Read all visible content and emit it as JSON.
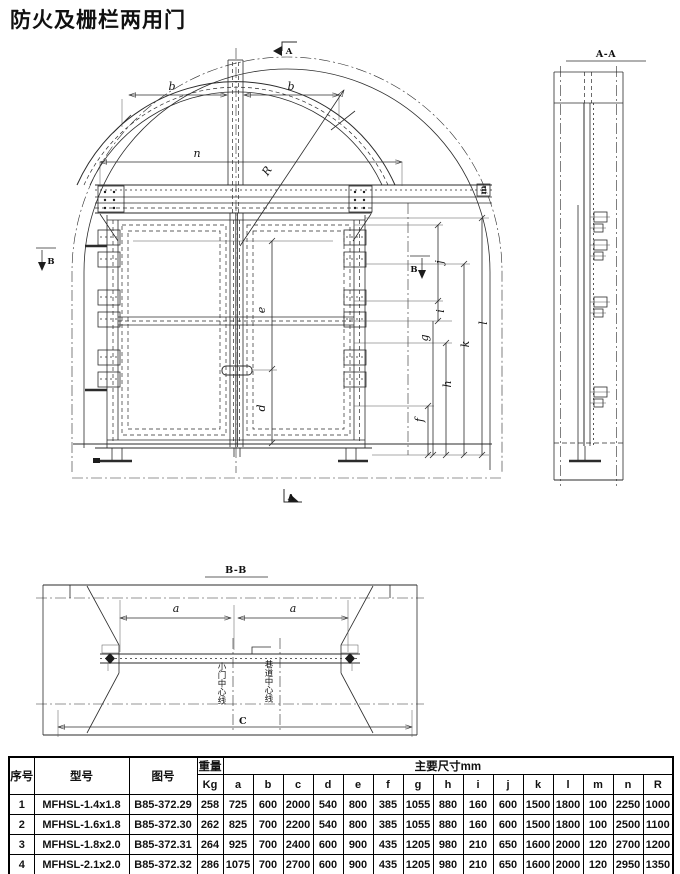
{
  "page": {
    "title": "防火及栅栏两用门"
  },
  "drawing": {
    "front_view": {
      "labels": {
        "b_left": "b",
        "b_right": "b",
        "n": "n",
        "R": "R",
        "e": "e",
        "d": "d",
        "f": "f",
        "g": "g",
        "h": "h",
        "i": "i",
        "j": "j",
        "k": "k",
        "l": "l",
        "m": "m"
      },
      "section_marks": {
        "a_top": "A",
        "a_bottom": "A",
        "b_left": "B",
        "b_right": "B"
      }
    },
    "section_aa": {
      "title": "A-A"
    },
    "section_bb": {
      "title": "B-B",
      "labels": {
        "a_left": "a",
        "a_right": "a",
        "c": "C",
        "door_centerline": "小门中心线",
        "tunnel_centerline": "巷道中心线"
      }
    }
  },
  "table": {
    "headers": {
      "seq": "序号",
      "model": "型号",
      "drawing_no": "图号",
      "weight": "重量",
      "weight_unit": "Kg",
      "dims_group": "主要尺寸mm"
    },
    "dim_columns": [
      "a",
      "b",
      "c",
      "d",
      "e",
      "f",
      "g",
      "h",
      "i",
      "j",
      "k",
      "l",
      "m",
      "n",
      "R"
    ],
    "rows": [
      {
        "no": "1",
        "model": "MFHSL-1.4x1.8",
        "drawing": "B85-372.29",
        "weight": "258",
        "dims": [
          "725",
          "600",
          "2000",
          "540",
          "800",
          "385",
          "1055",
          "880",
          "160",
          "600",
          "1500",
          "1800",
          "100",
          "2250",
          "1000"
        ]
      },
      {
        "no": "2",
        "model": "MFHSL-1.6x1.8",
        "drawing": "B85-372.30",
        "weight": "262",
        "dims": [
          "825",
          "700",
          "2200",
          "540",
          "800",
          "385",
          "1055",
          "880",
          "160",
          "600",
          "1500",
          "1800",
          "100",
          "2500",
          "1100"
        ]
      },
      {
        "no": "3",
        "model": "MFHSL-1.8x2.0",
        "drawing": "B85-372.31",
        "weight": "264",
        "dims": [
          "925",
          "700",
          "2400",
          "600",
          "900",
          "435",
          "1205",
          "980",
          "210",
          "650",
          "1600",
          "2000",
          "120",
          "2700",
          "1200"
        ]
      },
      {
        "no": "4",
        "model": "MFHSL-2.1x2.0",
        "drawing": "B85-372.32",
        "weight": "286",
        "dims": [
          "1075",
          "700",
          "2700",
          "600",
          "900",
          "435",
          "1205",
          "980",
          "210",
          "650",
          "1600",
          "2000",
          "120",
          "2950",
          "1350"
        ]
      }
    ]
  }
}
